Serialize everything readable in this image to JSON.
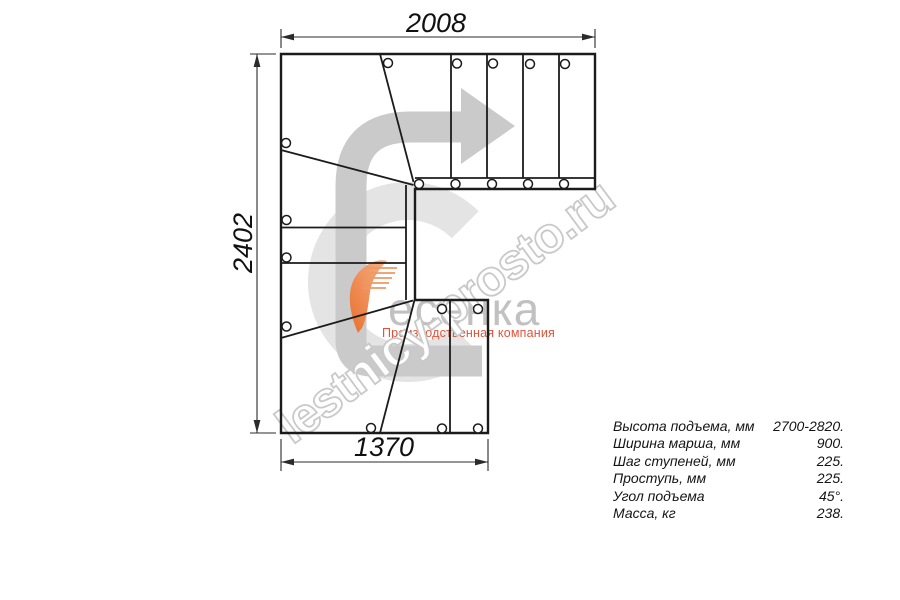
{
  "drawing": {
    "dim_top": "2008",
    "dim_left": "2402",
    "dim_bottom": "1370"
  },
  "specs": {
    "rows": [
      {
        "label": "Высота подъема, мм",
        "value": "2700-2820."
      },
      {
        "label": "Ширина марша, мм",
        "value": "900."
      },
      {
        "label": "Шаг ступеней, мм",
        "value": "225."
      },
      {
        "label": "Проступь, мм",
        "value": "225."
      },
      {
        "label": "Угол подъема",
        "value": "45°."
      },
      {
        "label": "Масса, кг",
        "value": "238."
      }
    ]
  },
  "logo": {
    "brand": "есенка",
    "subtitle": "Производственная компания"
  },
  "watermark": {
    "text": "lestnicy-prosto.ru"
  },
  "icons": {
    "direction_arrow": "u-turn-right-arrow",
    "logo_swoosh": "orange-stair-swoosh",
    "watermark_ring": "large-c-ring"
  },
  "colors": {
    "line": "#1b1b1b",
    "arrow_gray": "#cacaca",
    "ring_gray": "#e4e4e4",
    "watermark_stroke": "#c9c9c9",
    "logo_gray": "#c1c1c1",
    "logo_red": "#e0533a",
    "logo_orange": "#ec7c3c"
  }
}
